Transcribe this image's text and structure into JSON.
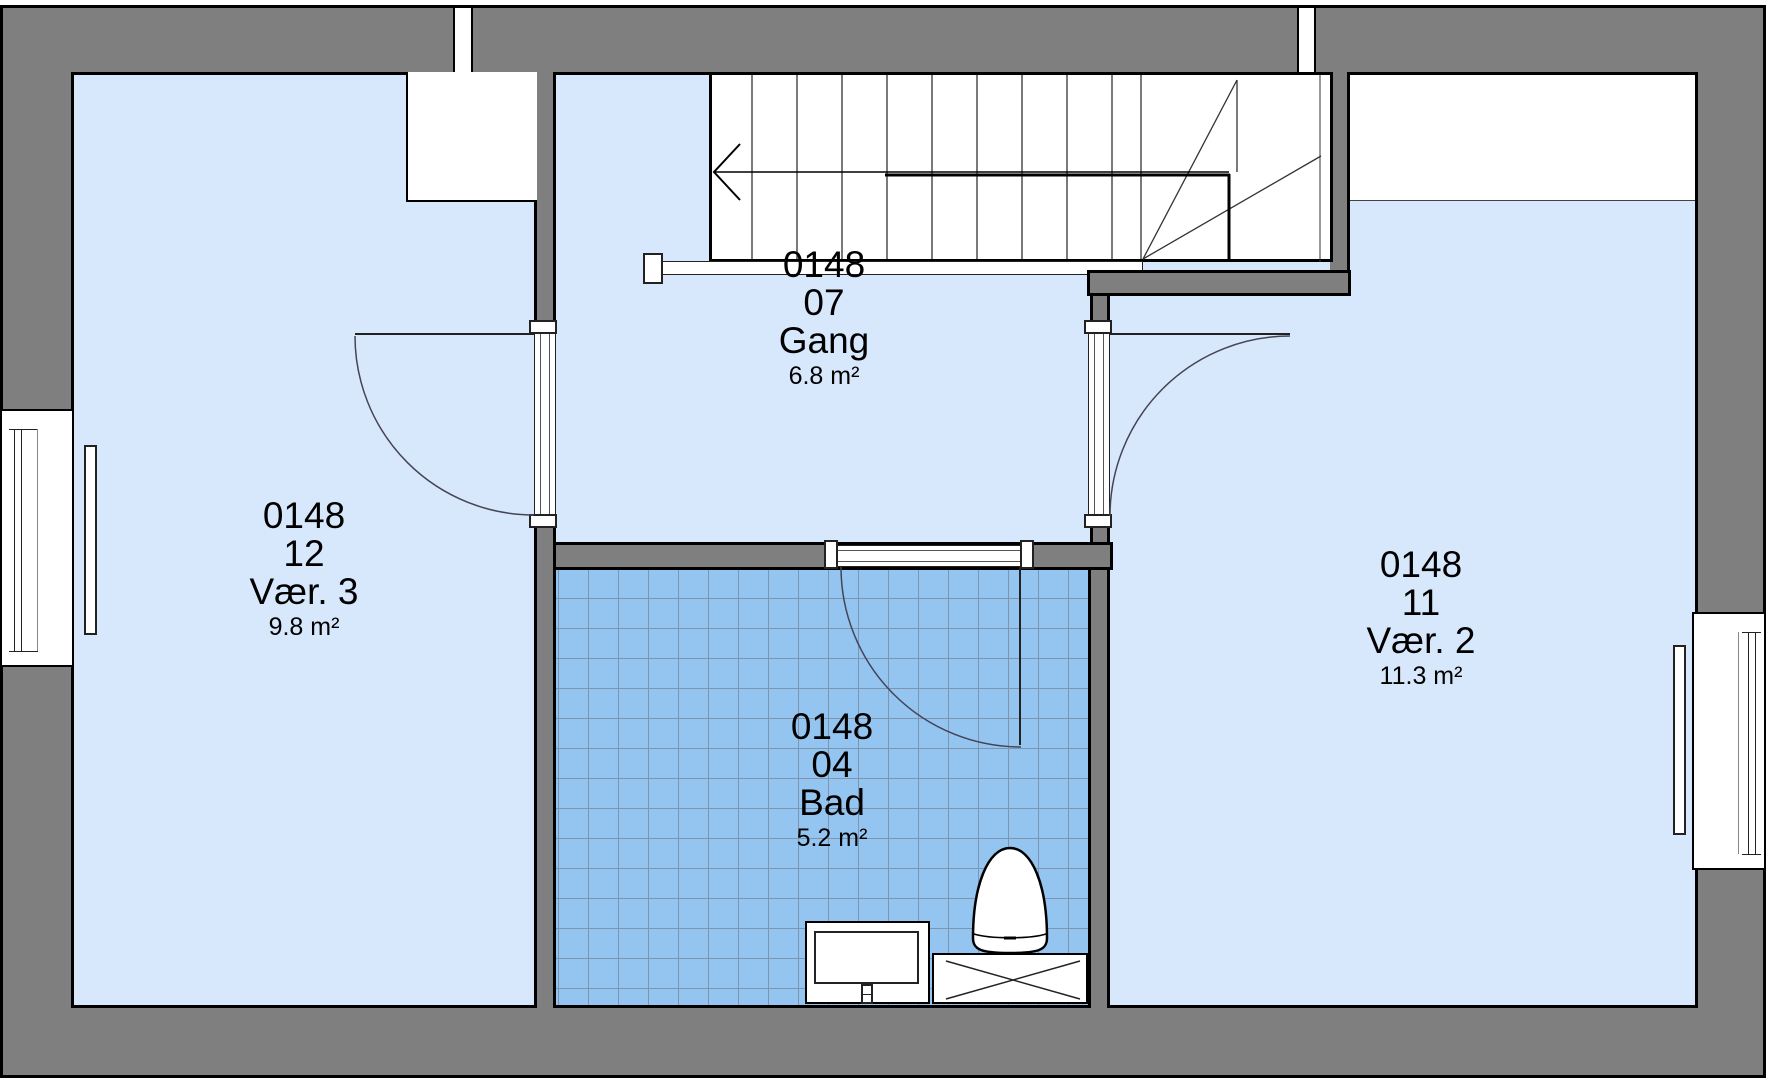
{
  "plan": {
    "rooms": [
      {
        "code": "0148",
        "number": "12",
        "name": "Vær. 3",
        "area": "9.8 m²"
      },
      {
        "code": "0148",
        "number": "07",
        "name": "Gang",
        "area": "6.8 m²"
      },
      {
        "code": "0148",
        "number": "04",
        "name": "Bad",
        "area": "5.2 m²"
      },
      {
        "code": "0148",
        "number": "11",
        "name": "Vær. 2",
        "area": "11.3 m²"
      }
    ],
    "colors": {
      "wall": "#7f7f7f",
      "outline": "#000000",
      "floor": "#d8e8fc",
      "bath_tile": "#94c5f1",
      "bath_tile_line": "#7e95af",
      "fixture_fill": "#ffffff",
      "label_text": "#000000"
    },
    "fixture_icons": {
      "stairs": "staircase-with-up-arrow",
      "toilet": "toilet-icon",
      "sink": "sink-vanity-icon",
      "appliance": "crossed-box-appliance-icon",
      "doors": "door-swing-arc-icon",
      "windows": "window-icon"
    }
  }
}
